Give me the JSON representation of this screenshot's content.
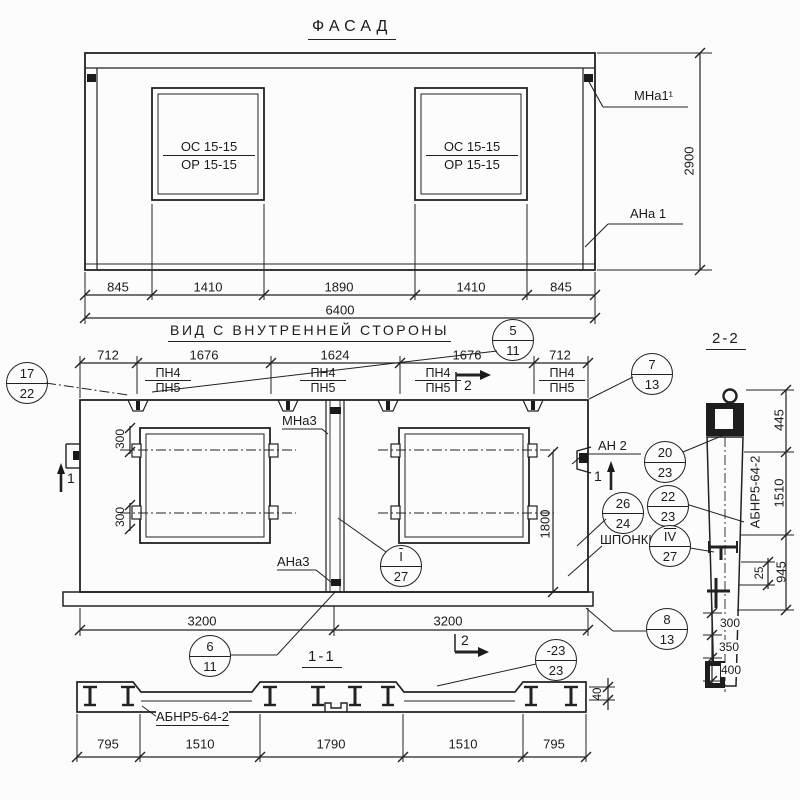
{
  "titles": {
    "facade": "ФАСАД",
    "inner": "ВИД С ВНУТРЕННЕЙ СТОРОНЫ",
    "section2": "2-2",
    "section1": "1-1"
  },
  "facade": {
    "window_top": "ОС 15-15",
    "window_bottom": "ОР 15-15",
    "mark_top_right": "МНа1¹",
    "mark_bottom_right": "АНа 1",
    "height": "2900",
    "total": "6400",
    "dims": [
      "845",
      "1410",
      "1890",
      "1410",
      "845"
    ]
  },
  "inner": {
    "dims_top": [
      "712",
      "1676",
      "1624",
      "1676",
      "712"
    ],
    "pn_top": "ПН4",
    "pn_bot": "ПН5",
    "mark_mna3": "МНа3",
    "mark_ana3": "АНа3",
    "mark_an2": "АН 2",
    "shponki": "ШПОНКИ",
    "dim_300": "300",
    "dim_1800": "1800",
    "dims_bottom": [
      "3200",
      "3200"
    ],
    "cut1": "1",
    "cut2": "2"
  },
  "section2": {
    "plate": "АБНР5-64-2",
    "d445": "445",
    "d1510": "1510",
    "d945": "945",
    "d25": "25",
    "d300": "300",
    "d350": "350",
    "d400": "400"
  },
  "section1": {
    "plate": "АБНР5-64-2",
    "d40": "40",
    "dims": [
      "795",
      "1510",
      "1790",
      "1510",
      "795"
    ]
  },
  "callouts": {
    "c17": {
      "t": "17",
      "b": "22"
    },
    "c5": {
      "t": "5",
      "b": "11"
    },
    "c7": {
      "t": "7",
      "b": "13"
    },
    "c20": {
      "t": "20",
      "b": "23"
    },
    "c26": {
      "t": "26",
      "b": "24"
    },
    "c22": {
      "t": "22",
      "b": "23"
    },
    "c4": {
      "t": "IV",
      "b": "27"
    },
    "c1": {
      "t": "I",
      "b": "27"
    },
    "c6": {
      "t": "6",
      "b": "11"
    },
    "c8": {
      "t": "8",
      "b": "13"
    },
    "c23": {
      "t": "-23",
      "b": "23"
    }
  }
}
